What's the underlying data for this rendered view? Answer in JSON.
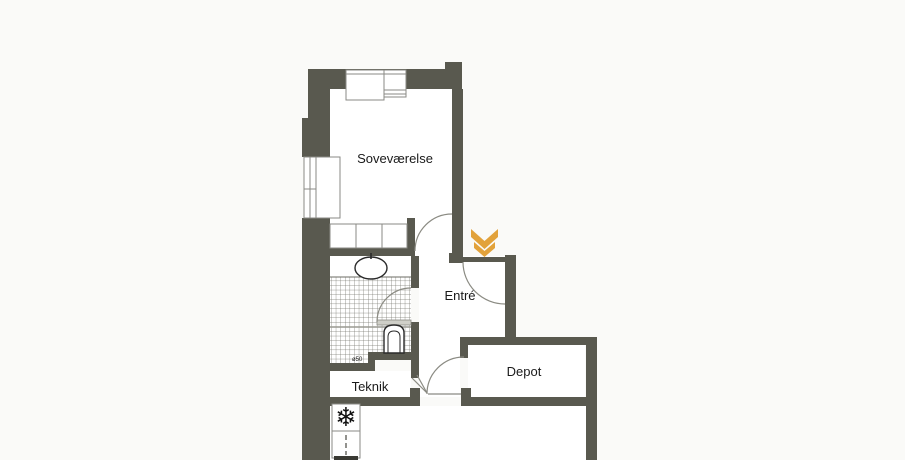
{
  "floorplan": {
    "rooms": [
      {
        "id": "sovevaerelse",
        "label": "Soveværelse"
      },
      {
        "id": "entre",
        "label": "Entré"
      },
      {
        "id": "teknik",
        "label": "Teknik"
      },
      {
        "id": "depot",
        "label": "Depot"
      }
    ],
    "symbols": {
      "entrance_arrow": "double-chevron-down",
      "freezer_glyph": "❄",
      "drain_label": "ø50"
    },
    "colors": {
      "wall": "#59594f",
      "background": "#fafaf8",
      "floor": "#ffffff",
      "accent": "#e2a23b",
      "outline": "#8a8a84",
      "text": "#1a1a1a"
    }
  }
}
